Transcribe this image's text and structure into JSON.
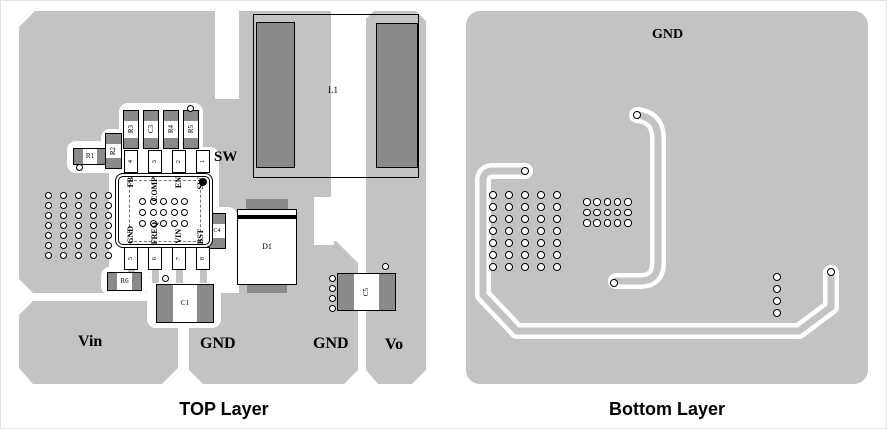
{
  "colors": {
    "pour": "#c3c3c3",
    "pad": "#8a8a8a"
  },
  "top_layer": {
    "caption": "TOP Layer",
    "labels": {
      "sw": "SW",
      "vin": "Vin",
      "gnd_left": "GND",
      "gnd_right": "GND",
      "vo": "Vo"
    },
    "components": {
      "r1": "R1",
      "r2": "R2",
      "r3": "R3",
      "c3": "C3",
      "r4": "R4",
      "r5": "R5",
      "r6": "R6",
      "c1": "C1",
      "c4": "C4",
      "c5": "C5",
      "d1": "D1",
      "l1": "L1"
    },
    "ic": {
      "pins_top": [
        "FB",
        "COMP",
        "EN",
        "SW"
      ],
      "pins_bottom": [
        "GND",
        "FREQ",
        "VIN",
        "BST"
      ],
      "pads_top": [
        "4",
        "3",
        "2",
        "1"
      ],
      "pads_bottom": [
        "5",
        "6",
        "7",
        "8"
      ]
    }
  },
  "bottom_layer": {
    "caption": "Bottom Layer",
    "gnd_label": "GND"
  }
}
